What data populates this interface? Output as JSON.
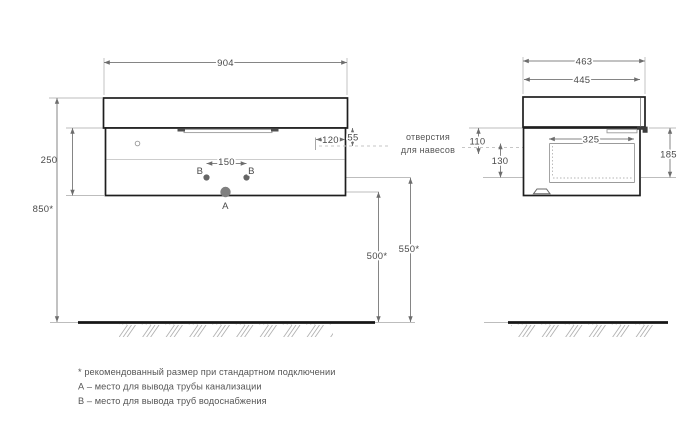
{
  "front_view": {
    "width_label": "904",
    "cabinet_height_label": "250",
    "mount_height_label": "850*",
    "hanger_offset_x_label": "120",
    "hanger_offset_y_label": "55",
    "water_spacing_label": "150",
    "drain_height_label": "500*",
    "water_height_label": "550*",
    "point_b_left_label": "B",
    "point_b_right_label": "B",
    "point_a_label": "А"
  },
  "side_view": {
    "overall_depth_label": "463",
    "body_depth_label": "445",
    "drawer_depth_label": "325",
    "hanger_top_offset_label": "110",
    "hanger_mid_offset_label": "130",
    "drawer_height_label": "185"
  },
  "annotations": {
    "hanger_holes_line1": "отверстия",
    "hanger_holes_line2": "для навесов"
  },
  "footnotes": [
    "* рекомендованный размер при стандартном подключении",
    "А – место для вывода трубы канализации",
    "В – место для вывода труб водоснабжения"
  ],
  "colors": {
    "outline": "#1e1e1e",
    "dimension": "#858585",
    "text": "#4a4a4a",
    "fill_point": "#666666"
  }
}
